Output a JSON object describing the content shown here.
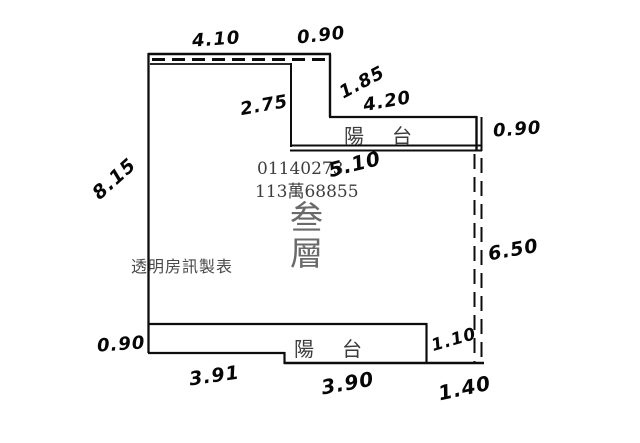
{
  "plan": {
    "floor_label": "叁層",
    "serial_number": "01140273",
    "reference_number": "113萬68855",
    "watermark": "透明房訊製表",
    "upper_balcony_label": "陽台",
    "lower_balcony_label": "陽台",
    "colors": {
      "wall_line": "#0d0d0d",
      "handwriting": "#060606",
      "printed_text": "#3d3d3d",
      "floor_text": "#6a6a6a"
    },
    "dimensions": {
      "top_width": "4.10",
      "top_notch_width": "0.90",
      "upper_right_step": "1.85",
      "interior_height": "2.75",
      "upper_balcony_width": "4.20",
      "upper_balcony_height": "0.90",
      "below_balcony_width": "5.10",
      "left_wall_height": "8.15",
      "right_side_height": "6.50",
      "lower_balcony_height": "0.90",
      "bottom_left_width": "3.91",
      "bottom_middle_width": "3.90",
      "bottom_right_width": "1.40",
      "bottom_notch_height": "1.10"
    }
  }
}
